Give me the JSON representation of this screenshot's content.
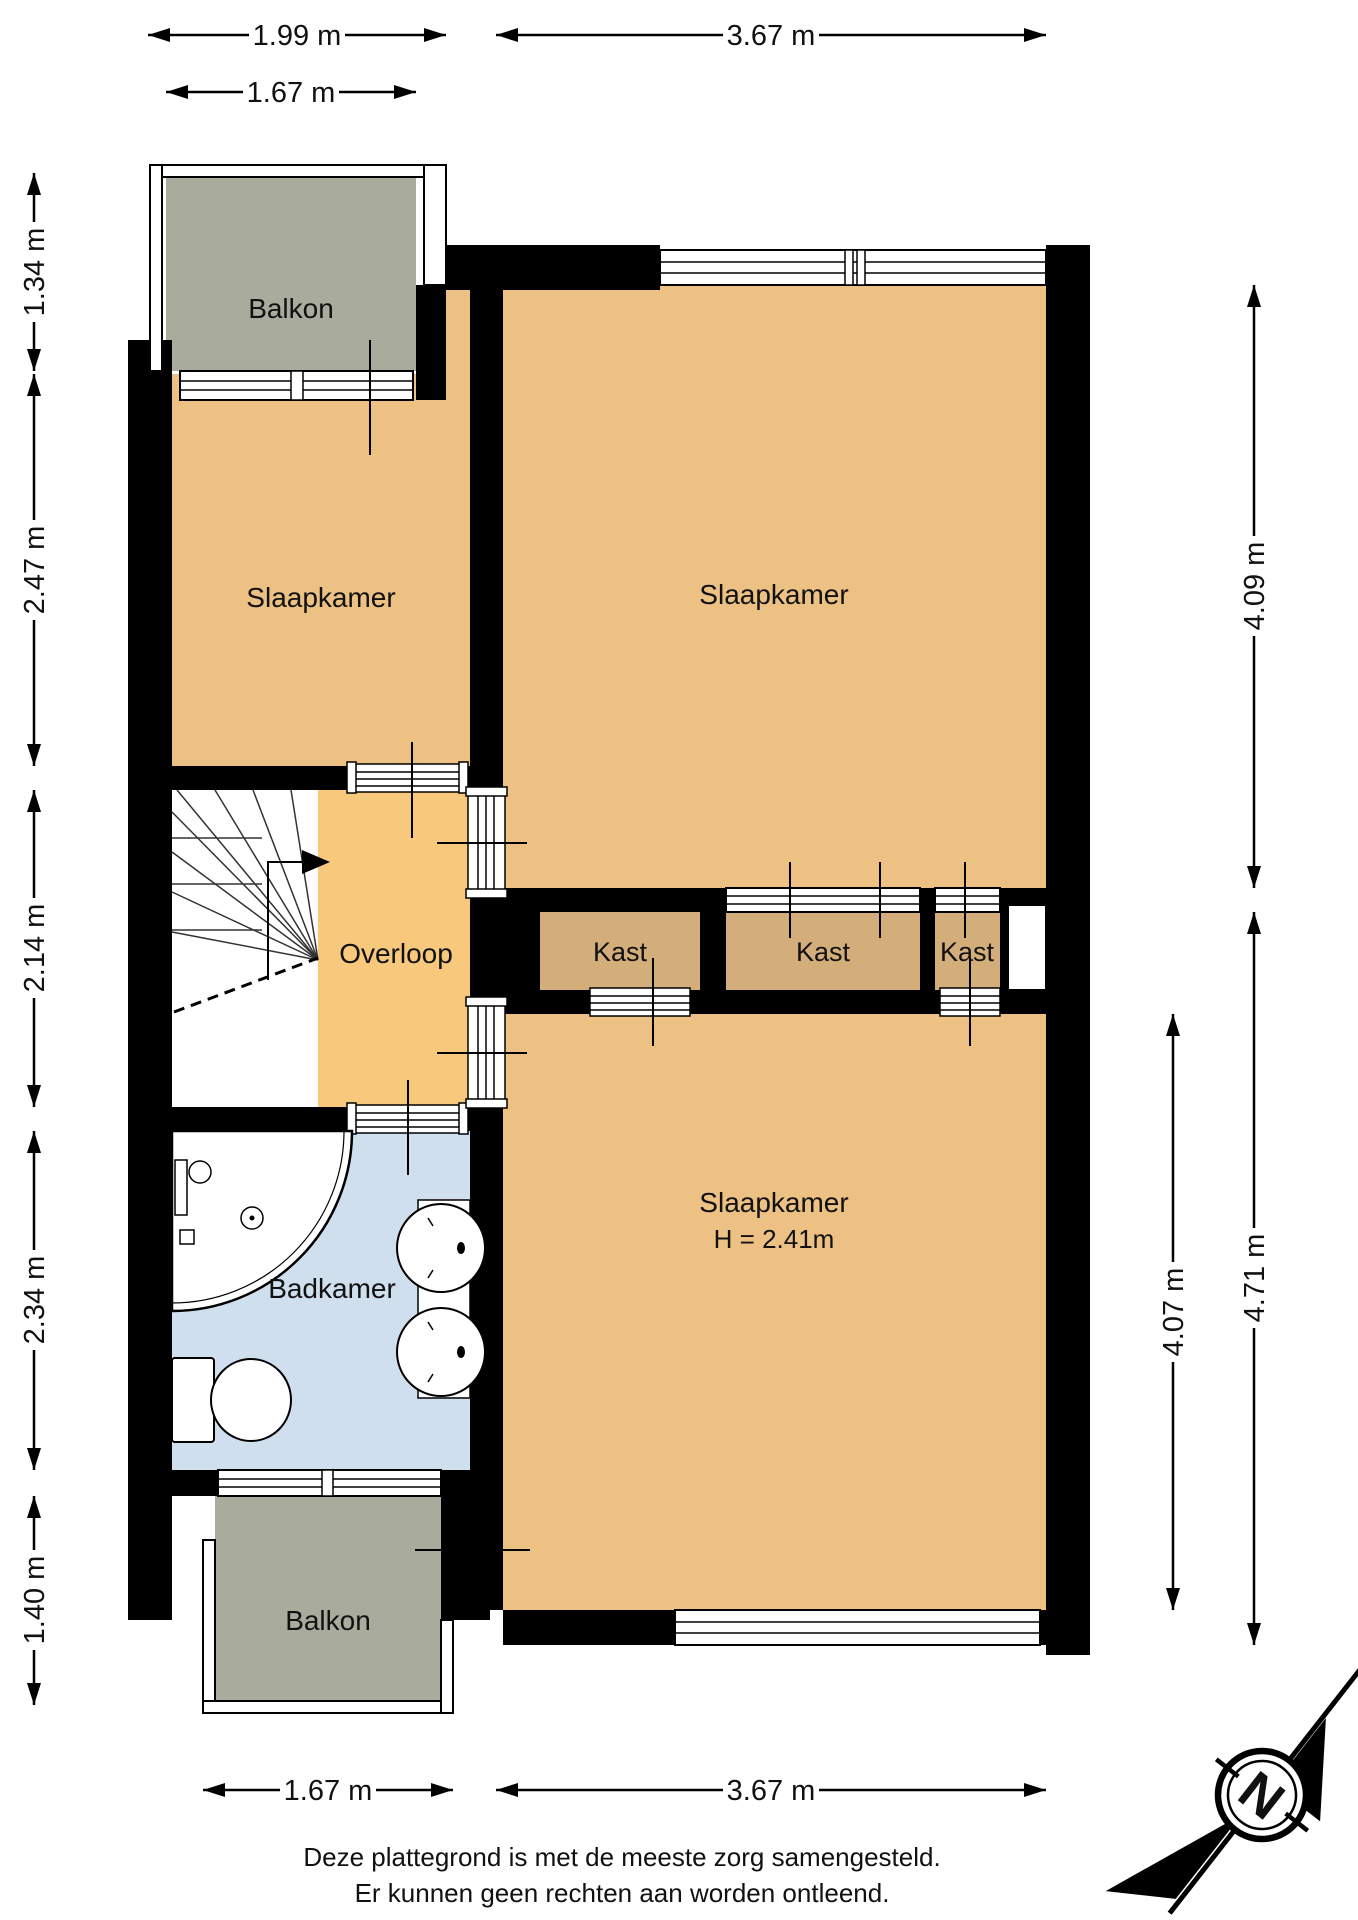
{
  "rooms": {
    "balkon_top": {
      "label": "Balkon"
    },
    "slaapkamer_left": {
      "label": "Slaapkamer"
    },
    "slaapkamer_right": {
      "label": "Slaapkamer"
    },
    "overloop": {
      "label": "Overloop"
    },
    "kast_1": {
      "label": "Kast"
    },
    "kast_2": {
      "label": "Kast"
    },
    "kast_3": {
      "label": "Kast"
    },
    "slaapkamer_bottom": {
      "label": "Slaapkamer",
      "ceiling_height": "H = 2.41m"
    },
    "badkamer": {
      "label": "Badkamer"
    },
    "balkon_bottom": {
      "label": "Balkon"
    }
  },
  "dimensions": {
    "top_outer_left": "1.99 m",
    "top_outer_right": "3.67 m",
    "top_inner_left": "1.67 m",
    "left_1": "1.34 m",
    "left_2": "2.47 m",
    "left_3": "2.14 m",
    "left_4": "2.34 m",
    "left_5": "1.40 m",
    "right_top": "4.09 m",
    "right_outer": "4.71 m",
    "right_inner": "4.07 m",
    "bottom_left": "1.67 m",
    "bottom_right": "3.67 m"
  },
  "compass": {
    "north_label": "N"
  },
  "footer": {
    "line1": "Deze plattegrond is met de meeste zorg samengesteld.",
    "line2": "Er kunnen geen rechten aan worden ontleend."
  },
  "colors": {
    "wall": "#000000",
    "room_floor": "#ecc183",
    "overloop_floor": "#f8c87c",
    "kast_floor": "#d3ae7a",
    "balkon_floor": "#a9ab9d",
    "badkamer_floor": "#d0dfee"
  }
}
